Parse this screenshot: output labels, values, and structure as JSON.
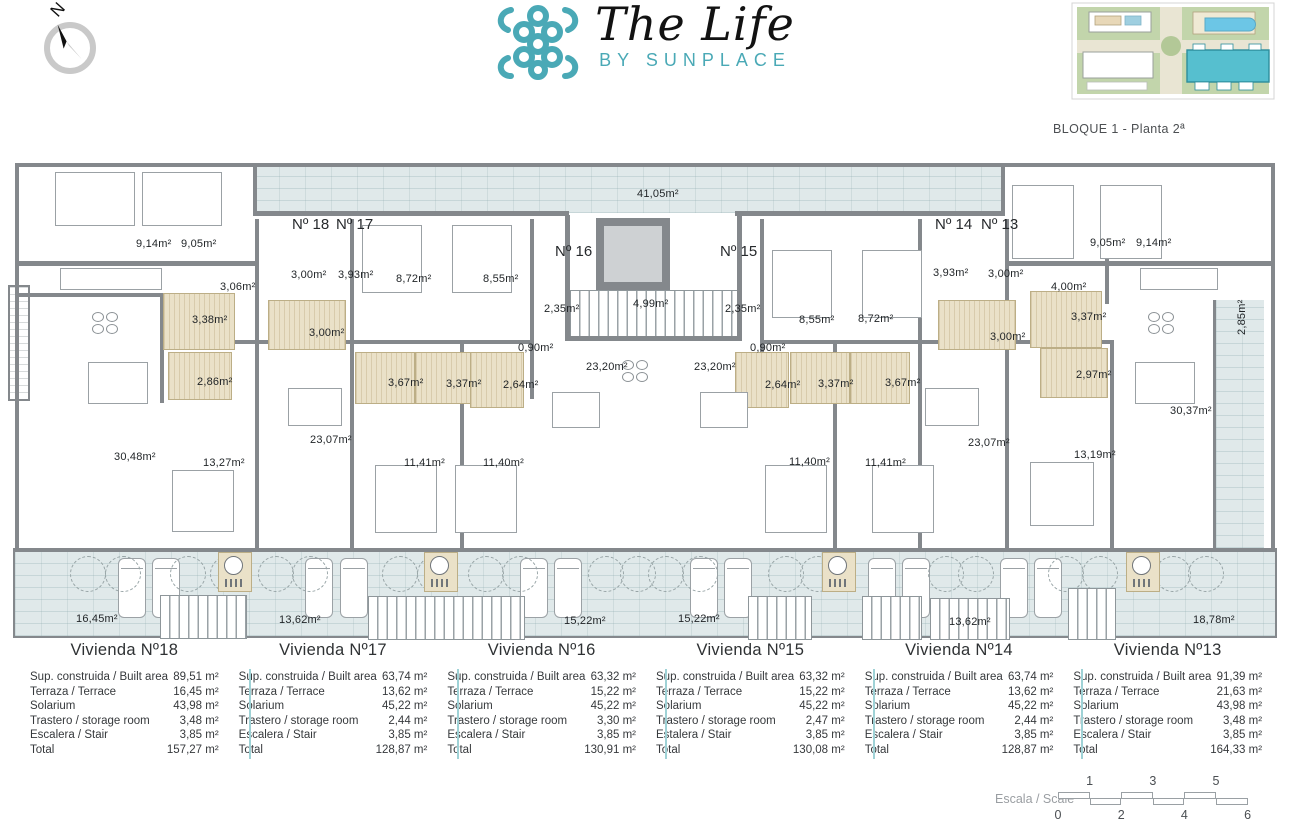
{
  "header": {
    "compass_label": "N",
    "logo": {
      "title": "The Life",
      "subtitle": "BY SUNPLACE"
    },
    "siteplan_caption": "BLOQUE 1 - Planta 2ª",
    "brand_color": "#4aa9b6"
  },
  "plan": {
    "unit_labels": [
      "Nº 18",
      "Nº 17",
      "Nº 16",
      "Nº 15",
      "Nº 14",
      "Nº 13"
    ],
    "room_labels": [
      "41,05m²",
      "9,14m²",
      "9,05m²",
      "3,06m²",
      "3,00m²",
      "3,93m²",
      "8,72m²",
      "8,55m²",
      "2,35m²",
      "4,99m²",
      "2,35m²",
      "8,55m²",
      "8,72m²",
      "3,93m²",
      "3,00m²",
      "9,05m²",
      "9,14m²",
      "4,00m²",
      "3,38m²",
      "3,00m²",
      "0,90m²",
      "23,20m²",
      "23,20m²",
      "0,90m²",
      "3,00m²",
      "3,37m²",
      "2,86m²",
      "3,67m²",
      "3,37m²",
      "2,64m²",
      "2,64m²",
      "3,37m²",
      "3,67m²",
      "2,97m²",
      "2,85m²",
      "30,48m²",
      "13,27m²",
      "23,07m²",
      "11,41m²",
      "11,40m²",
      "11,40m²",
      "11,41m²",
      "23,07m²",
      "13,19m²",
      "30,37m²",
      "16,45m²",
      "13,62m²",
      "15,22m²",
      "15,22m²",
      "13,62m²",
      "18,78m²"
    ],
    "colors": {
      "wall": "#84888c",
      "terrace": "#e0e9ea",
      "bathroom": "#eae1c8"
    }
  },
  "apartments": [
    {
      "title": "Vivienda Nº18",
      "rows": [
        {
          "label": "Sup. construida / Built area",
          "value": "89,51 m²"
        },
        {
          "label": "Terraza / Terrace",
          "value": "16,45 m²"
        },
        {
          "label": "Solarium",
          "value": "43,98 m²"
        },
        {
          "label": "Trastero / storage room",
          "value": "3,48 m²"
        },
        {
          "label": "Escalera / Stair",
          "value": "3,85 m²"
        },
        {
          "label": "Total",
          "value": "157,27 m²"
        }
      ]
    },
    {
      "title": "Vivienda Nº17",
      "rows": [
        {
          "label": "Sup. construida / Built area",
          "value": "63,74 m²"
        },
        {
          "label": "Terraza / Terrace",
          "value": "13,62 m²"
        },
        {
          "label": "Solarium",
          "value": "45,22 m²"
        },
        {
          "label": "Trastero / storage room",
          "value": "2,44 m²"
        },
        {
          "label": "Escalera / Stair",
          "value": "3,85 m²"
        },
        {
          "label": "Total",
          "value": "128,87 m²"
        }
      ]
    },
    {
      "title": "Vivienda Nº16",
      "rows": [
        {
          "label": "Sup. construida / Built area",
          "value": "63,32 m²"
        },
        {
          "label": "Terraza / Terrace",
          "value": "15,22 m²"
        },
        {
          "label": "Solarium",
          "value": "45,22 m²"
        },
        {
          "label": "Trastero / storage room",
          "value": "3,30 m²"
        },
        {
          "label": "Escalera / Stair",
          "value": "3,85 m²"
        },
        {
          "label": "Total",
          "value": "130,91 m²"
        }
      ]
    },
    {
      "title": "Vivienda Nº15",
      "rows": [
        {
          "label": "Sup. construida / Built area",
          "value": "63,32 m²"
        },
        {
          "label": "Terraza / Terrace",
          "value": "15,22 m²"
        },
        {
          "label": "Solarium",
          "value": "45,22 m²"
        },
        {
          "label": "Trastero / storage room",
          "value": "2,47 m²"
        },
        {
          "label": "Estalera / Stair",
          "value": "3,85 m²"
        },
        {
          "label": "Total",
          "value": "130,08 m²"
        }
      ]
    },
    {
      "title": "Vivienda Nº14",
      "rows": [
        {
          "label": "Sup. construida / Built area",
          "value": "63,74 m²"
        },
        {
          "label": "Terraza / Terrace",
          "value": "13,62 m²"
        },
        {
          "label": "Solarium",
          "value": "45,22 m²"
        },
        {
          "label": "Trastero / storage room",
          "value": "2,44 m²"
        },
        {
          "label": "Escalera / Stair",
          "value": "3,85 m²"
        },
        {
          "label": "Total",
          "value": "128,87 m²"
        }
      ]
    },
    {
      "title": "Vivienda Nº13",
      "rows": [
        {
          "label": "Sup. construida / Built area",
          "value": "91,39 m²"
        },
        {
          "label": "Terraza / Terrace",
          "value": "21,63 m²"
        },
        {
          "label": "Solarium",
          "value": "43,98 m²"
        },
        {
          "label": "Trastero / storage room",
          "value": "3,48 m²"
        },
        {
          "label": "Escalera / Stair",
          "value": "3,85 m²"
        },
        {
          "label": "Total",
          "value": "164,33 m²"
        }
      ]
    }
  ],
  "scale": {
    "label": "Escala / Scale",
    "upper_ticks": [
      "1",
      "3",
      "5"
    ],
    "lower_ticks": [
      "0",
      "2",
      "4",
      "6"
    ]
  }
}
